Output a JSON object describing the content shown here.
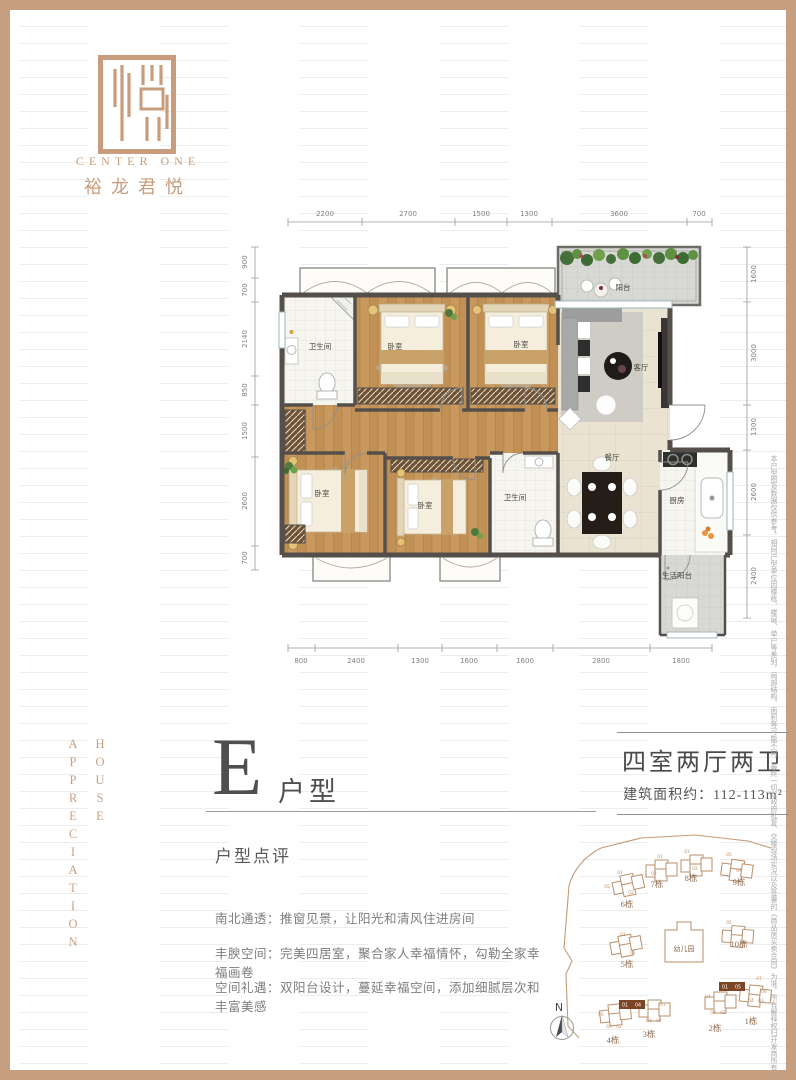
{
  "brand": {
    "logo_en": "CENTER ONE",
    "logo_cn": "裕龙君悦"
  },
  "side": {
    "house": "HOUSE",
    "appreciation": "APPRECIATION",
    "disclaimer": "本户型图及数据仅供参考，相同户型单位因楼栋、楼层、单户等差别，局部结构、面积等可能不同，最终一切以政府批复、交楼现场实况以及签署的《商品房买卖合同》为准，所有解释权归开发商所有。"
  },
  "plan": {
    "rooms": {
      "balcony": "阳台",
      "bath1": "卫生间",
      "bed1": "卧室",
      "bed2": "卧室",
      "living": "客厅",
      "dining": "餐厅",
      "kitchen": "厨房",
      "service": "生活阳台",
      "bed3": "卧室",
      "bed4": "卧室",
      "bath2": "卫生间"
    },
    "dims_top": [
      "2200",
      "2700",
      "1500",
      "1300",
      "3600",
      "700"
    ],
    "dims_bottom": [
      "800",
      "2400",
      "1300",
      "1600",
      "1600",
      "2800",
      "1800"
    ],
    "dims_left": [
      "900",
      "700",
      "2140",
      "850",
      "1500",
      "2600",
      "700"
    ],
    "dims_right": [
      "1600",
      "3000",
      "1300",
      "2600",
      "2400"
    ]
  },
  "unit": {
    "letter": "E",
    "suffix": "户型",
    "layout": "四室两厅两卫",
    "area": "建筑面积约：112-113m²"
  },
  "review": {
    "heading": "户型点评",
    "items": [
      "南北通透：推窗见景，让阳光和清风住进房间",
      "丰腴空间：完美四居室，聚合家人幸福情怀，勾勒全家幸福画卷",
      "空间礼遇：双阳台设计，蔓延幸福空间，添加细腻层次和丰富美感"
    ]
  },
  "site": {
    "north": "N",
    "kindergarten": "幼儿园",
    "buildings": [
      "6栋",
      "7栋",
      "8栋",
      "9栋",
      "10栋",
      "5栋",
      "4栋",
      "3栋",
      "2栋",
      "1栋"
    ],
    "unit_nums": [
      "01",
      "02",
      "03",
      "04",
      "05",
      "06",
      "07"
    ]
  },
  "colors": {
    "accent": "#c69e80",
    "wall": "#544f4a",
    "wood_floor": "#c8985e",
    "unit_highlight": "#7c4526"
  }
}
